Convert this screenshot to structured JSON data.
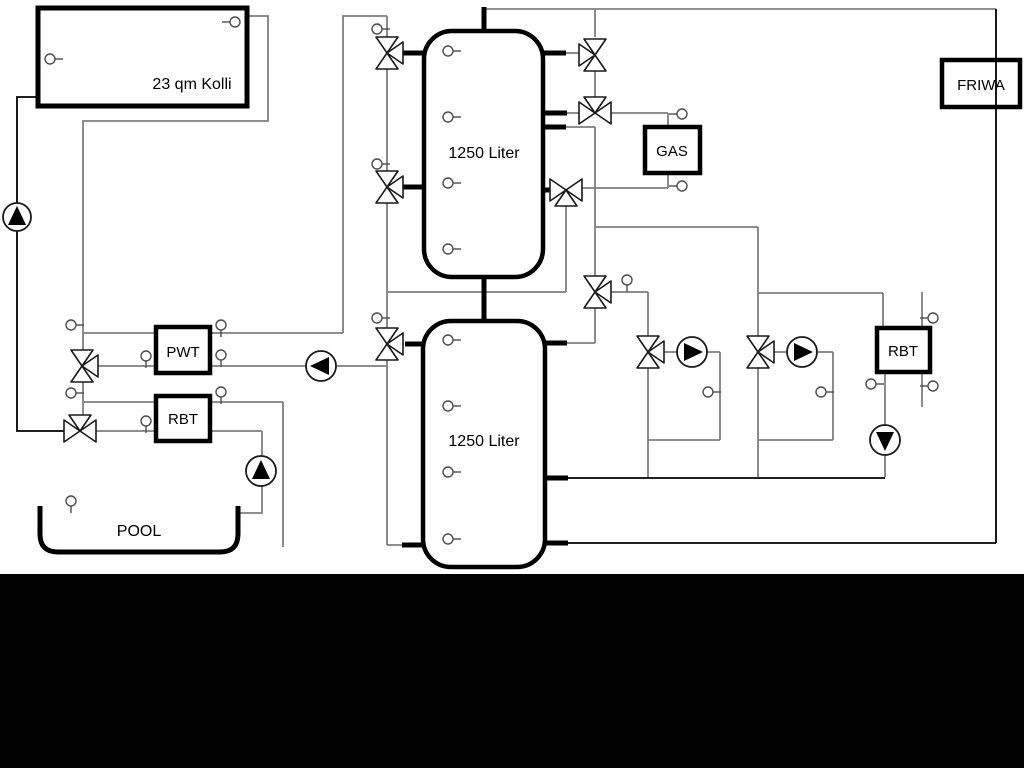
{
  "labels": {
    "collector": "23 qm Kolli",
    "tank_upper": "1250 Liter",
    "tank_lower": "1250 Liter",
    "pwt": "PWT",
    "rbt_left": "RBT",
    "pool": "POOL",
    "gas": "GAS",
    "friwa": "FRIWA",
    "rbt_right": "RBT"
  },
  "colors": {
    "pipe_gray": "#7f7f7f",
    "pipe_black": "#000000",
    "background": "#ffffff",
    "footer_bar": "#000000"
  }
}
